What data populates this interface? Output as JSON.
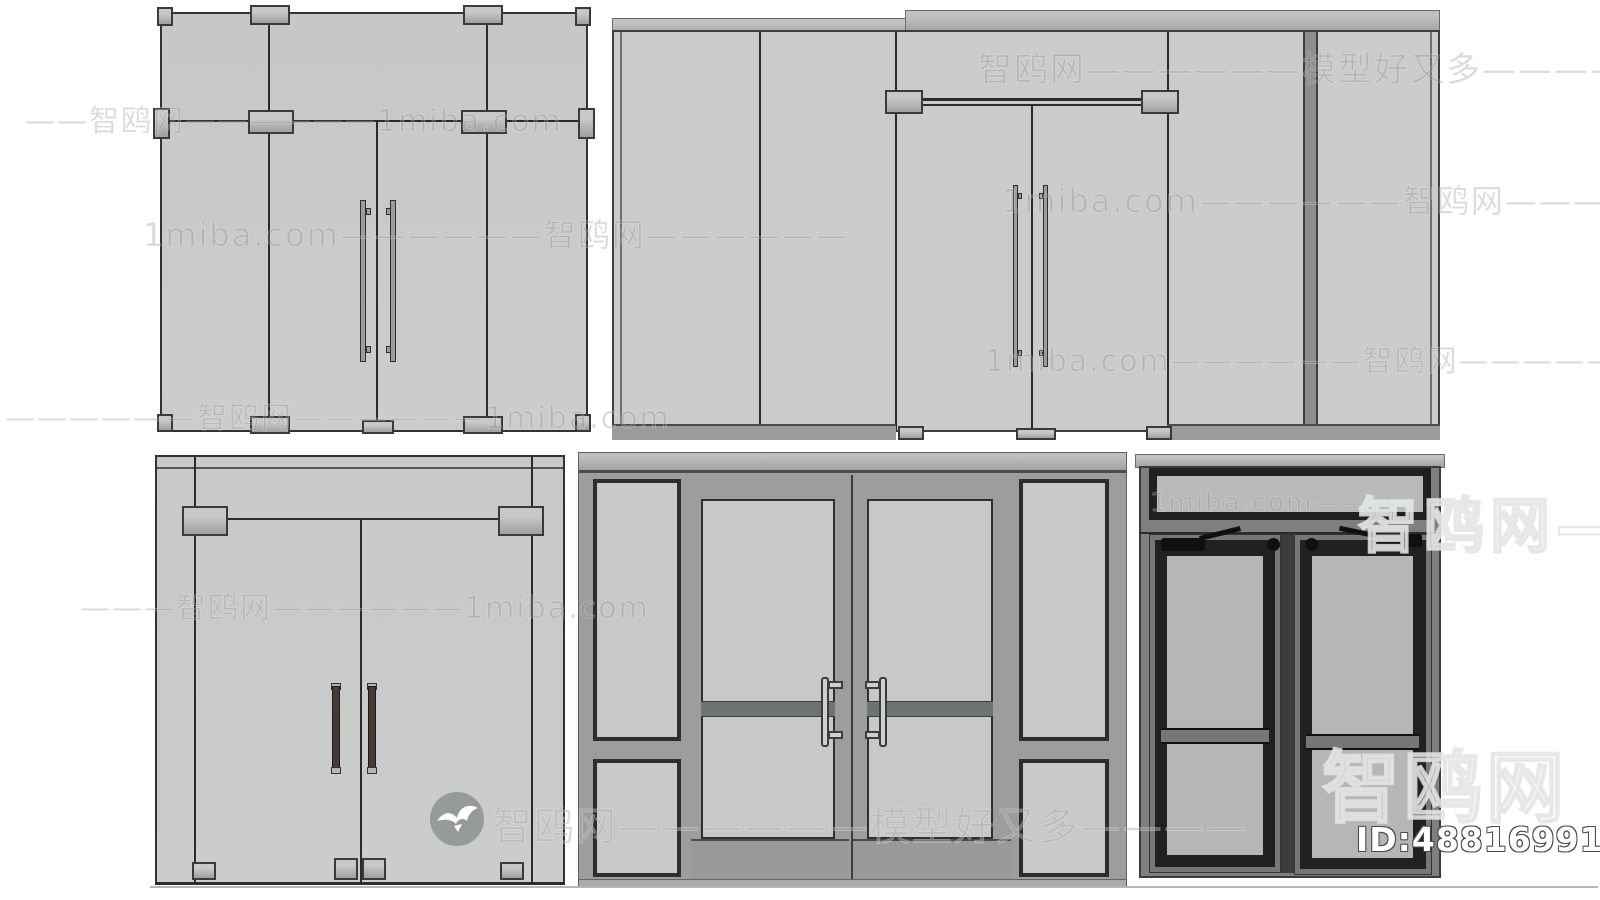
{
  "watermarks": {
    "site_name": "智鸥网",
    "rows": [
      {
        "text": "智鸥网——————模型好又多————"
      },
      {
        "text": "——智鸥网——————1miba.com"
      },
      {
        "text": "1miba.com——————智鸥网————"
      },
      {
        "text": "1miba.com——————智鸥网——————"
      },
      {
        "text": "1miba.com——————智鸥网—————1miba.com"
      },
      {
        "text": "——————智鸥网——————1miba.com"
      },
      {
        "text": "———智鸥网——————1miba.com"
      },
      {
        "text": "智鸥网——————模型好又多————"
      },
      {
        "text": "1miba.com——————"
      },
      {
        "text": "智鸥网————"
      },
      {
        "text": "智鸥网"
      }
    ],
    "id_label": "ID:488169914"
  },
  "icons": {
    "logo": "seagull-in-circle"
  },
  "colors": {
    "background": "#ffffff",
    "glass": "#c9cbca",
    "frame_gray": "#9b9e9d",
    "dark_frame": "#3a3d3c",
    "charcoal_trim": "#1f2120",
    "push_bar": "#6e7271",
    "watermark_gray": "#8c908e",
    "id_text": "#ffffff"
  }
}
